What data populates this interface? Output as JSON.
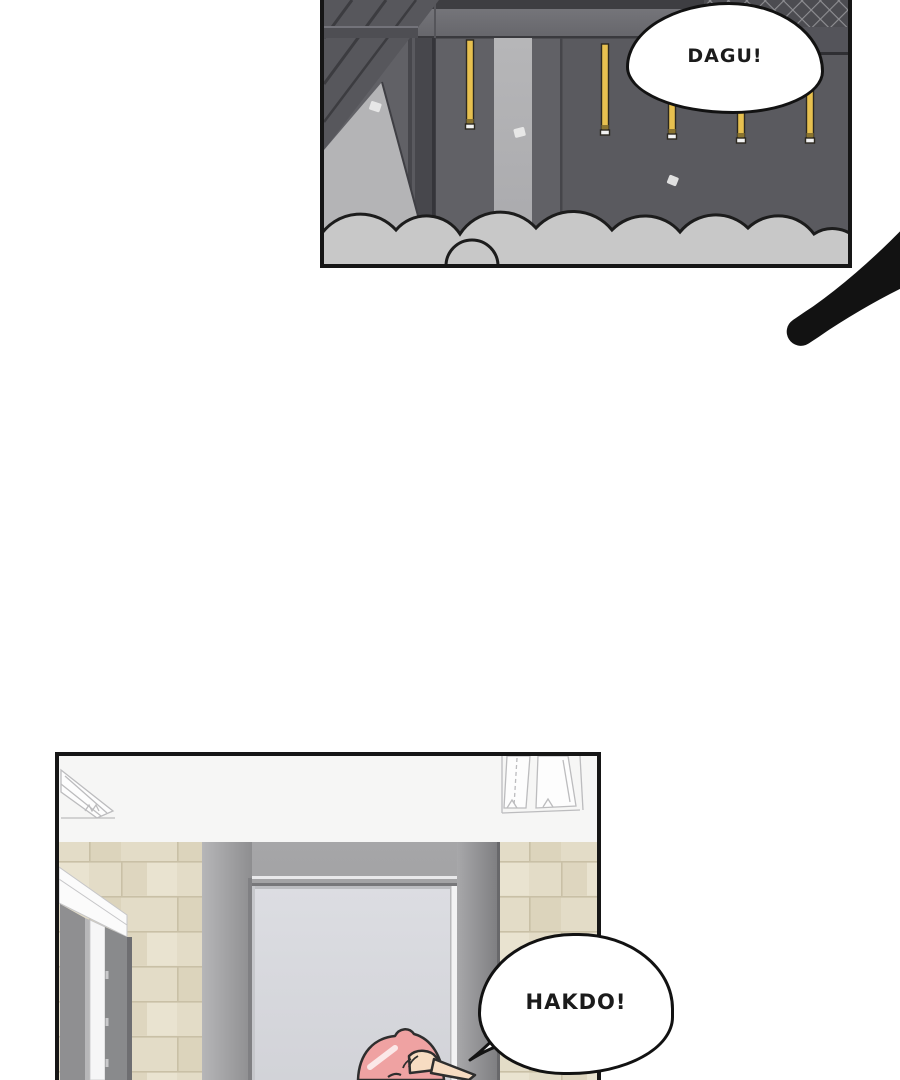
{
  "page": {
    "type": "webtoon-comic-page",
    "background": "#ffffff",
    "panel_border": "#161616"
  },
  "panels": {
    "rooftop": {
      "label": "rooftop-construction-panel",
      "bubble": {
        "text": "DAGU!"
      },
      "elements": [
        "steel-beam",
        "guard-mesh-fence",
        "hanging-yellow-poles",
        "dust-clouds",
        "concrete-pillar",
        "paper-debris"
      ],
      "colors": {
        "wall": "#606065",
        "wall_right": "#5a5a5f",
        "beam_band": "#6e6e73",
        "dark_beam": "#57575c",
        "light_concrete": "#b4b4b6",
        "pole_yellow": "#e7c04f",
        "cloud": "#c8c8c8",
        "mesh": "#4c4c51"
      }
    },
    "hallway": {
      "label": "hallway-doorway-panel",
      "bubble": {
        "text": "HAKDO!"
      },
      "elements": [
        "ceiling-light-fixture",
        "tiled-wall",
        "gray-door-frame",
        "open-doorway",
        "white-door-jamb",
        "pink-haired-character"
      ],
      "colors": {
        "ceiling": "#f6f6f5",
        "tile_beige": "#e3dcc7",
        "tile_grout": "#c9c0a6",
        "door_frame": "#9a9a9c",
        "door_interior": "#d8d9de",
        "hair_pink": "#efa2a2",
        "skin": "#f7dcc2"
      }
    }
  }
}
